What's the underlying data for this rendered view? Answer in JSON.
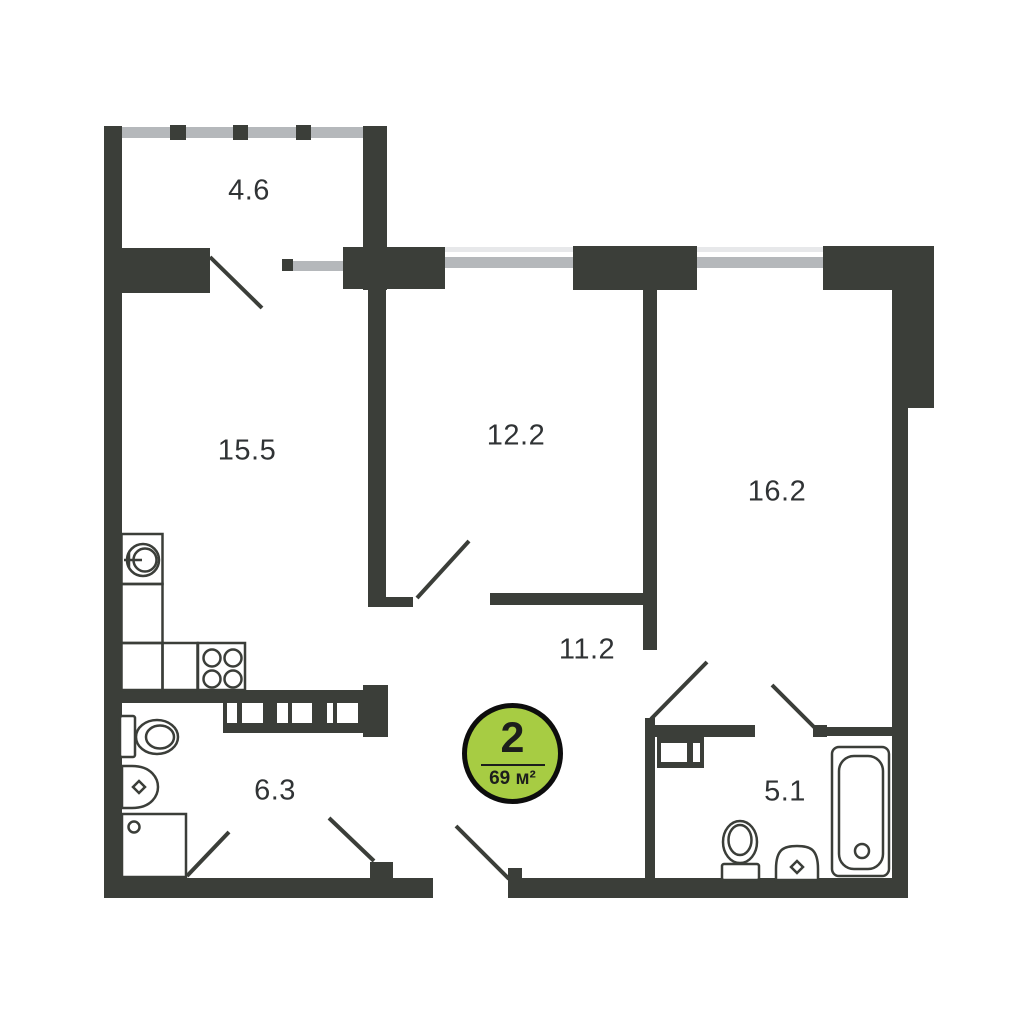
{
  "plan": {
    "badge": {
      "rooms_count": "2",
      "total_area": "69 м²"
    },
    "rooms": [
      {
        "name": "balcony",
        "area": "4.6"
      },
      {
        "name": "kitchen-living",
        "area": "15.5"
      },
      {
        "name": "bedroom-1",
        "area": "12.2"
      },
      {
        "name": "bedroom-2",
        "area": "16.2"
      },
      {
        "name": "hallway",
        "area": "11.2"
      },
      {
        "name": "bathroom-1",
        "area": "6.3"
      },
      {
        "name": "bathroom-2",
        "area": "5.1"
      }
    ],
    "colors": {
      "wall": "#3b3e39",
      "window": "#b5b8bb",
      "window_light": "#e7e8ea",
      "badge_fill": "#a7cc43",
      "badge_border": "#0d0d0d",
      "label_text": "#303335"
    }
  }
}
